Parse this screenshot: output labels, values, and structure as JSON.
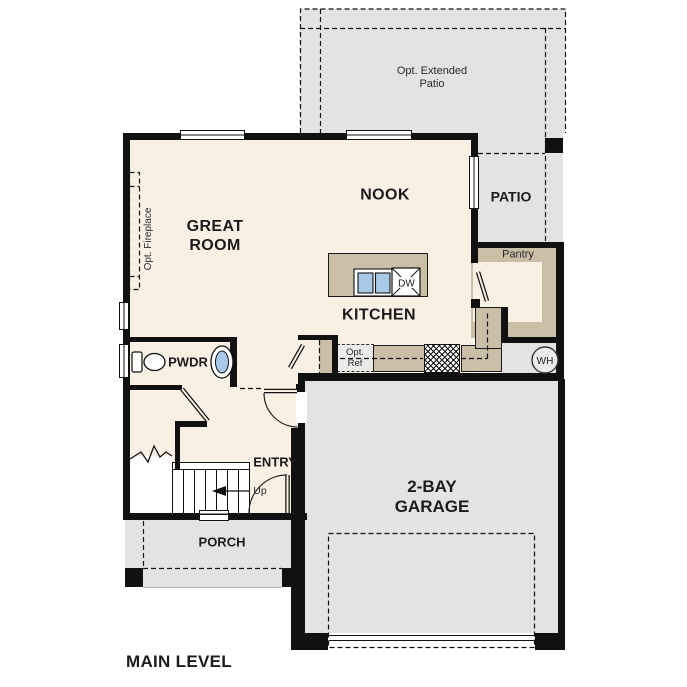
{
  "floor_plan": {
    "level_title": "MAIN LEVEL",
    "rooms": {
      "great_room": "GREAT\nROOM",
      "nook": "NOOK",
      "kitchen": "KITCHEN",
      "pantry": "Pantry",
      "powder_room": "PWDR",
      "entry": "ENTRY",
      "garage": "2-BAY\nGARAGE",
      "porch": "PORCH",
      "patio": "PATIO",
      "optional_extended_patio": "Opt. Extended\nPatio"
    },
    "annotations": {
      "optional_fireplace": "Opt. Fireplace",
      "optional_refrigerator": "Opt.\nRef",
      "stairs_direction": "Up",
      "dishwasher": "DW",
      "water_heater": "WH"
    },
    "colors": {
      "wall": "#111111",
      "floor": "#f8f0e2",
      "hard_surface_gray": "#e4e3e1",
      "casework_tan": "#cabfa6",
      "fixture_blue": "#a9c9e9"
    }
  }
}
